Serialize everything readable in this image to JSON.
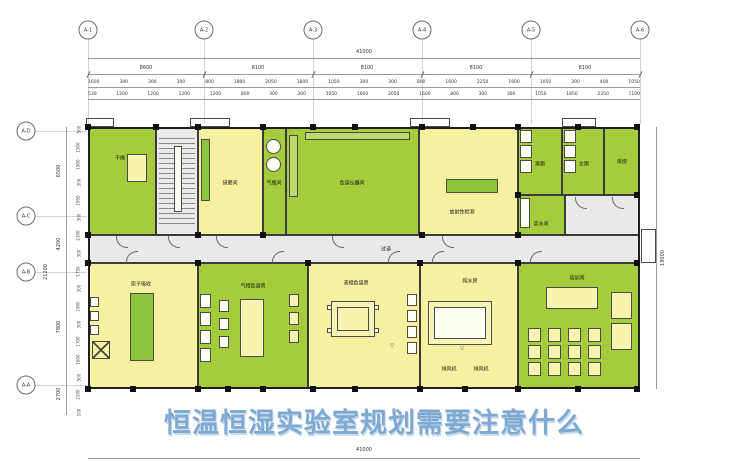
{
  "title": {
    "text": "恒温恒湿实验室规划需要注意什么"
  },
  "colors": {
    "green": "#a5cd3b",
    "yellow": "#f5f1a0",
    "gray": "#e9e9e9",
    "title_blue": "#7ea9d1"
  },
  "axes": {
    "top": [
      "A-1",
      "A-2",
      "A-3",
      "A-4",
      "A-5",
      "A-6"
    ],
    "left": [
      "A-D",
      "A-C",
      "A-B",
      "A-A"
    ]
  },
  "dimensions": {
    "top_total": "41000",
    "top_bays": [
      "8600",
      "8100",
      "8100",
      "8100",
      "8100"
    ],
    "top_sub_row1": [
      "1600",
      "300",
      "300",
      "300",
      "800",
      "1800",
      "2050",
      "1800",
      "1050",
      "300",
      "300",
      "800",
      "1600",
      "2250",
      "1600",
      "1050",
      "300",
      "400",
      "1050"
    ],
    "top_sub_row2": [
      "530",
      "1200",
      "1200",
      "1200",
      "1200",
      "800",
      "300",
      "300",
      "1050",
      "1600",
      "2050",
      "1600",
      "800",
      "300",
      "300",
      "1050",
      "1850",
      "2350",
      "1100"
    ],
    "left_main": [
      "6500",
      "4200",
      "7800",
      "2700"
    ],
    "left_overall": "21200",
    "left_sub": [
      "500",
      "1500",
      "1900",
      "300",
      "1950",
      "300",
      "2100",
      "300",
      "1750",
      "300",
      "1900",
      "300",
      "1700",
      "1600",
      "500",
      "2100",
      "100"
    ],
    "right_total": "19000",
    "bottom_total": "41000"
  },
  "rooms": {
    "drying": {
      "label": "干燥"
    },
    "grinding": {
      "label": "研磨间"
    },
    "gas": {
      "label": "气瓶间"
    },
    "chromatograph": {
      "label": "色谱仪器间"
    },
    "radioactive": {
      "label": "放射性检测"
    },
    "male_toilet": {
      "label": "男厕"
    },
    "female_toilet": {
      "label": "女厕"
    },
    "storage": {
      "label": "库房"
    },
    "tea": {
      "label": "茶水间"
    },
    "corridor": {
      "label": "过道"
    },
    "atomic": {
      "label": "原子吸收"
    },
    "gc": {
      "label": "气相色谱房"
    },
    "lc": {
      "label": "液相色谱房"
    },
    "pure_water": {
      "label": "纯水房"
    },
    "training": {
      "label": "培训间"
    }
  },
  "annotations": {
    "fan": "排风机",
    "elevation_mark": "▽"
  }
}
